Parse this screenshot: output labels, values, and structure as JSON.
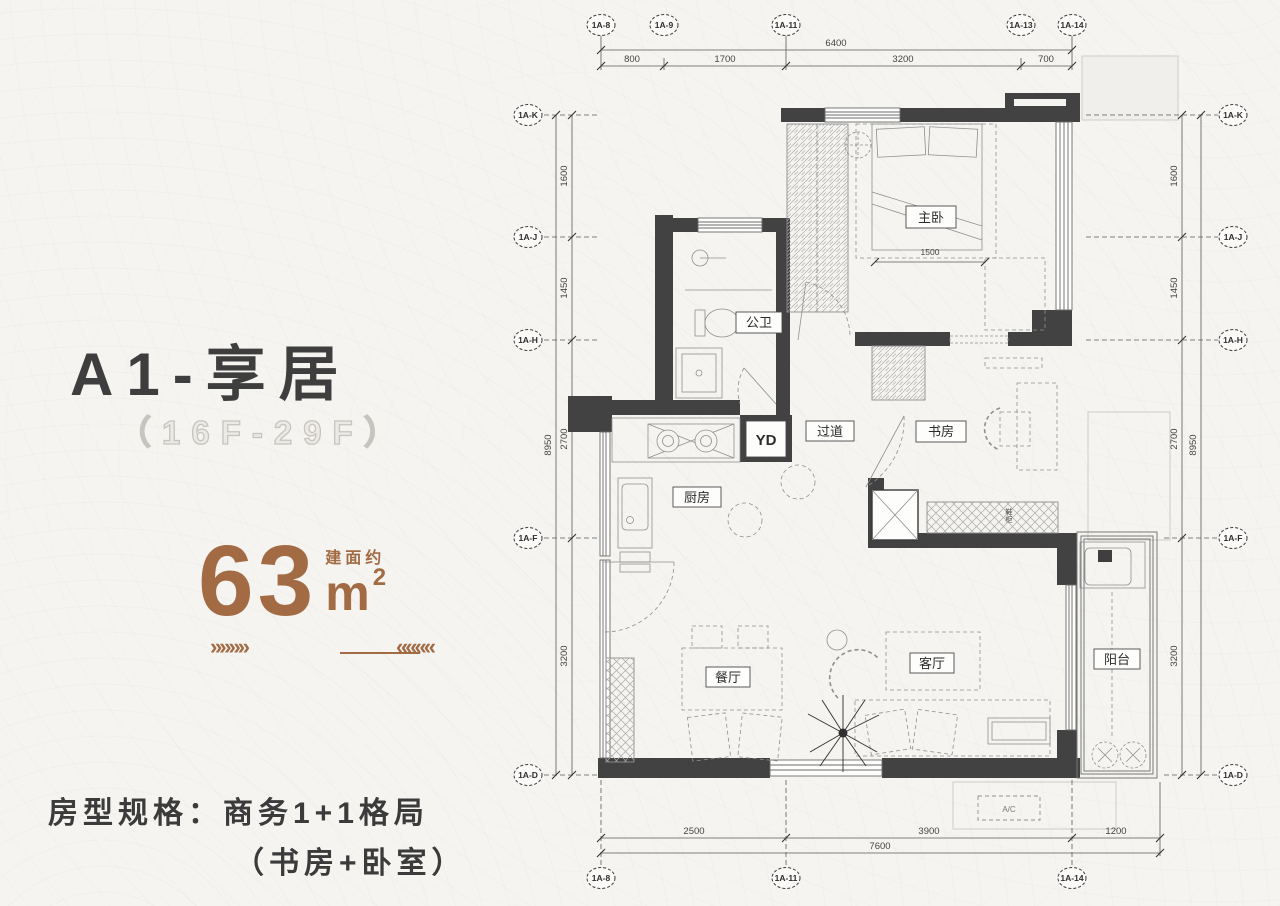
{
  "panel": {
    "title": "A1-享居",
    "floors": "（16F-29F）",
    "area_prefix": "建面约",
    "area_value": "63",
    "area_unit": "m",
    "area_sup": "2",
    "arrows_left": "»»»»",
    "arrows_right": "««««",
    "spec_line1": "房型规格：商务1+1格局",
    "spec_line2": "（书房+卧室）"
  },
  "axes": {
    "top": [
      "1A-8",
      "1A-9",
      "1A-11",
      "1A-13",
      "1A-14"
    ],
    "bottom": [
      "1A-8",
      "1A-11",
      "1A-14"
    ],
    "left": [
      "1A-K",
      "1A-J",
      "1A-H",
      "1A-F",
      "1A-D"
    ],
    "right": [
      "1A-K",
      "1A-J",
      "1A-H",
      "1A-F",
      "1A-D"
    ]
  },
  "dims": {
    "top_total": "6400",
    "top_segments": [
      "800",
      "1700",
      "3200",
      "700"
    ],
    "bottom_total": "7600",
    "bottom_segments": [
      "2500",
      "3900",
      "1200"
    ],
    "left_total": "8950",
    "left_segments": [
      "1600",
      "1450",
      "2700",
      "3200"
    ],
    "right_total": "8950",
    "right_segments": [
      "1600",
      "1450",
      "2700",
      "3200"
    ],
    "bed_width": "1500"
  },
  "rooms": {
    "master": "主卧",
    "bath": "公卫",
    "hall": "过道",
    "study": "书房",
    "kitchen": "厨房",
    "duct": "YD",
    "dining": "餐厅",
    "living": "客厅",
    "balcony": "阳台",
    "cabinet": "鞋柜",
    "ac": "A/C"
  },
  "colors": {
    "accent": "#a26b44",
    "wall": "#424242",
    "ink": "#3b3b3b",
    "outline_text": "#c7c4bf"
  }
}
